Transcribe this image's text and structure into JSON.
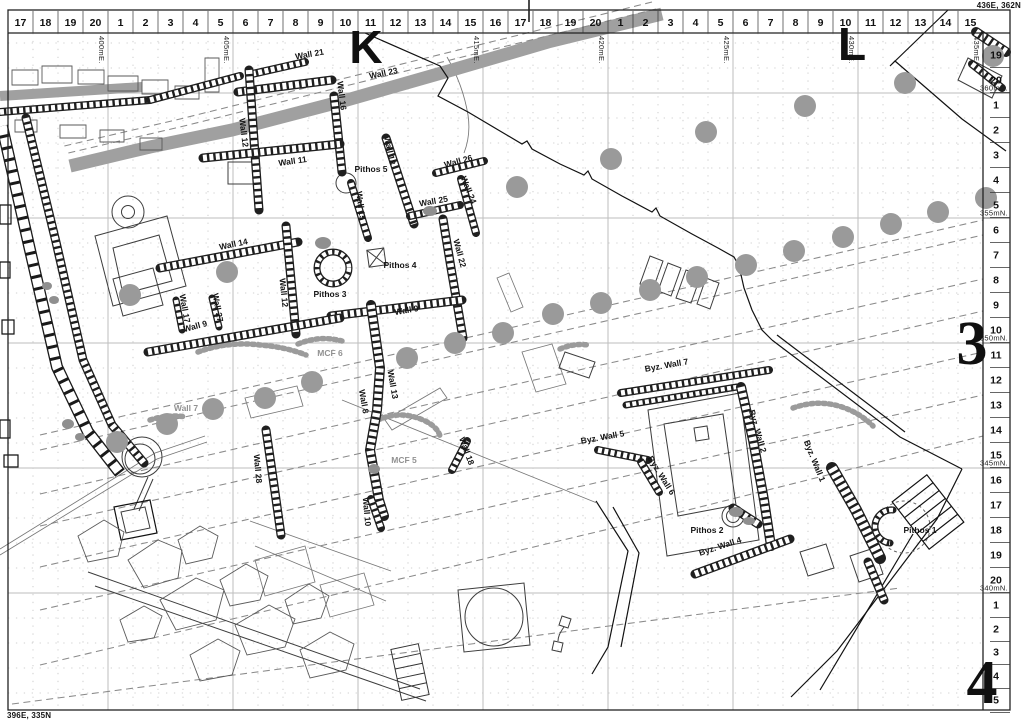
{
  "frame": {
    "corner_top_right": "436E, 362N",
    "corner_bottom_left": "396E, 335N"
  },
  "sheet_marks": {
    "letters": [
      {
        "label": "K",
        "x": 366,
        "y": 63
      },
      {
        "label": "L",
        "x": 852,
        "y": 60
      }
    ],
    "numbers": [
      {
        "label": "3",
        "x": 972,
        "y": 364
      },
      {
        "label": "4",
        "x": 982,
        "y": 703
      }
    ]
  },
  "top_ruler": {
    "cell_numbers": [
      "17",
      "18",
      "19",
      "20",
      "1",
      "2",
      "3",
      "4",
      "5",
      "6",
      "7",
      "8",
      "9",
      "10",
      "11",
      "12",
      "13",
      "14",
      "15",
      "16",
      "17",
      "18",
      "19",
      "20",
      "1",
      "2",
      "3",
      "4",
      "5",
      "6",
      "7",
      "8",
      "9",
      "10",
      "11",
      "12",
      "13",
      "14",
      "15"
    ],
    "easting_labels": [
      {
        "text": "400mE.",
        "x": 108
      },
      {
        "text": "405mE.",
        "x": 233
      },
      {
        "text": "415mE.",
        "x": 483
      },
      {
        "text": "420mE.",
        "x": 608
      },
      {
        "text": "425mE.",
        "x": 733
      },
      {
        "text": "430mE.",
        "x": 858
      },
      {
        "text": "435mE.",
        "x": 983
      }
    ]
  },
  "right_ruler": {
    "cell_numbers": [
      {
        "t": "19",
        "y": 55
      },
      {
        "t": "20",
        "y": 80
      },
      {
        "t": "1",
        "y": 105
      },
      {
        "t": "2",
        "y": 130
      },
      {
        "t": "3",
        "y": 155
      },
      {
        "t": "4",
        "y": 180
      },
      {
        "t": "5",
        "y": 205
      },
      {
        "t": "6",
        "y": 230
      },
      {
        "t": "7",
        "y": 255
      },
      {
        "t": "8",
        "y": 280
      },
      {
        "t": "9",
        "y": 305
      },
      {
        "t": "10",
        "y": 330
      },
      {
        "t": "11",
        "y": 355
      },
      {
        "t": "12",
        "y": 380
      },
      {
        "t": "13",
        "y": 405
      },
      {
        "t": "14",
        "y": 430
      },
      {
        "t": "15",
        "y": 455
      },
      {
        "t": "16",
        "y": 480
      },
      {
        "t": "17",
        "y": 505
      },
      {
        "t": "18",
        "y": 530
      },
      {
        "t": "19",
        "y": 555
      },
      {
        "t": "20",
        "y": 580
      },
      {
        "t": "1",
        "y": 605
      },
      {
        "t": "2",
        "y": 629
      },
      {
        "t": "3",
        "y": 652
      },
      {
        "t": "4",
        "y": 676
      },
      {
        "t": "5",
        "y": 700
      }
    ],
    "northing_labels": [
      {
        "text": "360mN.",
        "y": 93
      },
      {
        "text": "355mN.",
        "y": 218
      },
      {
        "text": "350mN.",
        "y": 343
      },
      {
        "text": "345mN.",
        "y": 468
      },
      {
        "text": "340mN.",
        "y": 593
      }
    ]
  },
  "features": {
    "labels": [
      {
        "t": "Wall 21",
        "x": 310,
        "y": 57,
        "r": -10
      },
      {
        "t": "Wall 23",
        "x": 384,
        "y": 76,
        "r": -12
      },
      {
        "t": "Wall 12",
        "x": 241,
        "y": 133,
        "r": 83
      },
      {
        "t": "Wall 16",
        "x": 339,
        "y": 96,
        "r": 83
      },
      {
        "t": "Wall 11",
        "x": 293,
        "y": 164,
        "r": -8
      },
      {
        "t": "Pithos 5",
        "x": 371,
        "y": 172,
        "r": 0
      },
      {
        "t": "Wall 18",
        "x": 387,
        "y": 151,
        "r": 78
      },
      {
        "t": "Wall 26",
        "x": 459,
        "y": 164,
        "r": -15
      },
      {
        "t": "Wall 24",
        "x": 466,
        "y": 191,
        "r": 68
      },
      {
        "t": "Wall 25",
        "x": 434,
        "y": 204,
        "r": -10
      },
      {
        "t": "Wall 15",
        "x": 358,
        "y": 206,
        "r": 83
      },
      {
        "t": "Wall 14",
        "x": 234,
        "y": 247,
        "r": -12
      },
      {
        "t": "Wall 22",
        "x": 457,
        "y": 254,
        "r": 75
      },
      {
        "t": "Wall 12",
        "x": 281,
        "y": 293,
        "r": 84
      },
      {
        "t": "Pithos 4",
        "x": 400,
        "y": 268,
        "r": 0
      },
      {
        "t": "Pithos 3",
        "x": 330,
        "y": 297,
        "r": 0
      },
      {
        "t": "Wall 17",
        "x": 182,
        "y": 309,
        "r": 80
      },
      {
        "t": "Wall 27",
        "x": 215,
        "y": 308,
        "r": 80
      },
      {
        "t": "Wall 9",
        "x": 196,
        "y": 329,
        "r": -15
      },
      {
        "t": "Wall 9",
        "x": 407,
        "y": 313,
        "r": -10
      },
      {
        "t": "Wall 13",
        "x": 390,
        "y": 385,
        "r": 80
      },
      {
        "t": "Wall 8",
        "x": 361,
        "y": 402,
        "r": 80
      },
      {
        "t": "Wall 28",
        "x": 255,
        "y": 469,
        "r": 85
      },
      {
        "t": "Wall 18",
        "x": 464,
        "y": 452,
        "r": 70
      },
      {
        "t": "Wall 10",
        "x": 364,
        "y": 512,
        "r": 85
      },
      {
        "t": "Byz. Wall 7",
        "x": 667,
        "y": 368,
        "r": -10
      },
      {
        "t": "Byz. Wall 5",
        "x": 603,
        "y": 440,
        "r": -10
      },
      {
        "t": "Byz. Wall 2",
        "x": 755,
        "y": 432,
        "r": 74
      },
      {
        "t": "Byz. Wall 6",
        "x": 659,
        "y": 477,
        "r": 58
      },
      {
        "t": "Byz. Wall 1",
        "x": 812,
        "y": 462,
        "r": 68
      },
      {
        "t": "Pithos 2",
        "x": 707,
        "y": 533,
        "r": 0
      },
      {
        "t": "Byz. Wall 4",
        "x": 721,
        "y": 549,
        "r": -18
      },
      {
        "t": "Pithos 1",
        "x": 920,
        "y": 533,
        "r": 0
      },
      {
        "t": "Wall 7",
        "x": 186,
        "y": 411,
        "r": 0,
        "muted": true
      },
      {
        "t": "MCF 6",
        "x": 330,
        "y": 356,
        "r": 0,
        "muted": true
      },
      {
        "t": "MCF 5",
        "x": 404,
        "y": 463,
        "r": 0,
        "muted": true
      }
    ],
    "tree_dots": [
      [
        993,
        56
      ],
      [
        905,
        83
      ],
      [
        805,
        106
      ],
      [
        706,
        132
      ],
      [
        611,
        159
      ],
      [
        517,
        187
      ],
      [
        986,
        198
      ],
      [
        938,
        212
      ],
      [
        891,
        224
      ],
      [
        843,
        237
      ],
      [
        794,
        251
      ],
      [
        746,
        265
      ],
      [
        697,
        277
      ],
      [
        650,
        290
      ],
      [
        601,
        303
      ],
      [
        553,
        314
      ],
      [
        503,
        333
      ],
      [
        455,
        343
      ],
      [
        407,
        358
      ],
      [
        312,
        382
      ],
      [
        265,
        398
      ],
      [
        213,
        409
      ],
      [
        167,
        424
      ],
      [
        117,
        442
      ],
      [
        227,
        272
      ],
      [
        130,
        295
      ]
    ]
  },
  "colors": {
    "tree_dot": "#9a9a9a",
    "road_band": "#a0a0a0",
    "muted_label": "#919191",
    "grid": "#c3c3c3"
  }
}
